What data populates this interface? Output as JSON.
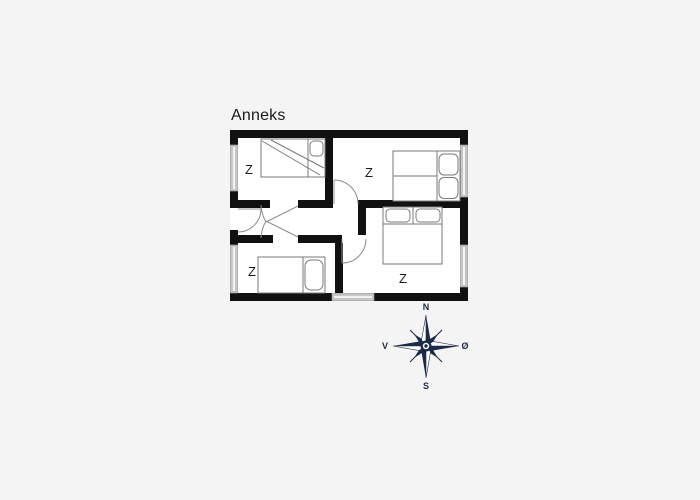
{
  "title": "Anneks",
  "rooms": [
    {
      "name": "bedroom-top-left",
      "label": "Z"
    },
    {
      "name": "bedroom-top-right",
      "label": "Z"
    },
    {
      "name": "bedroom-bottom-left",
      "label": "Z"
    },
    {
      "name": "bedroom-bottom-right",
      "label": "Z"
    }
  ],
  "compass": {
    "north": "N",
    "south": "S",
    "west": "V",
    "east": "Ø"
  },
  "colors": {
    "background": "#f4f4f4",
    "wall": "#111111",
    "room_fill": "#ffffff",
    "window": "#c6c6c6",
    "door_line": "#8c8c8c",
    "bed_line": "#7a7a7a",
    "compass": "#1b2a45",
    "text": "#1a1a1a"
  }
}
